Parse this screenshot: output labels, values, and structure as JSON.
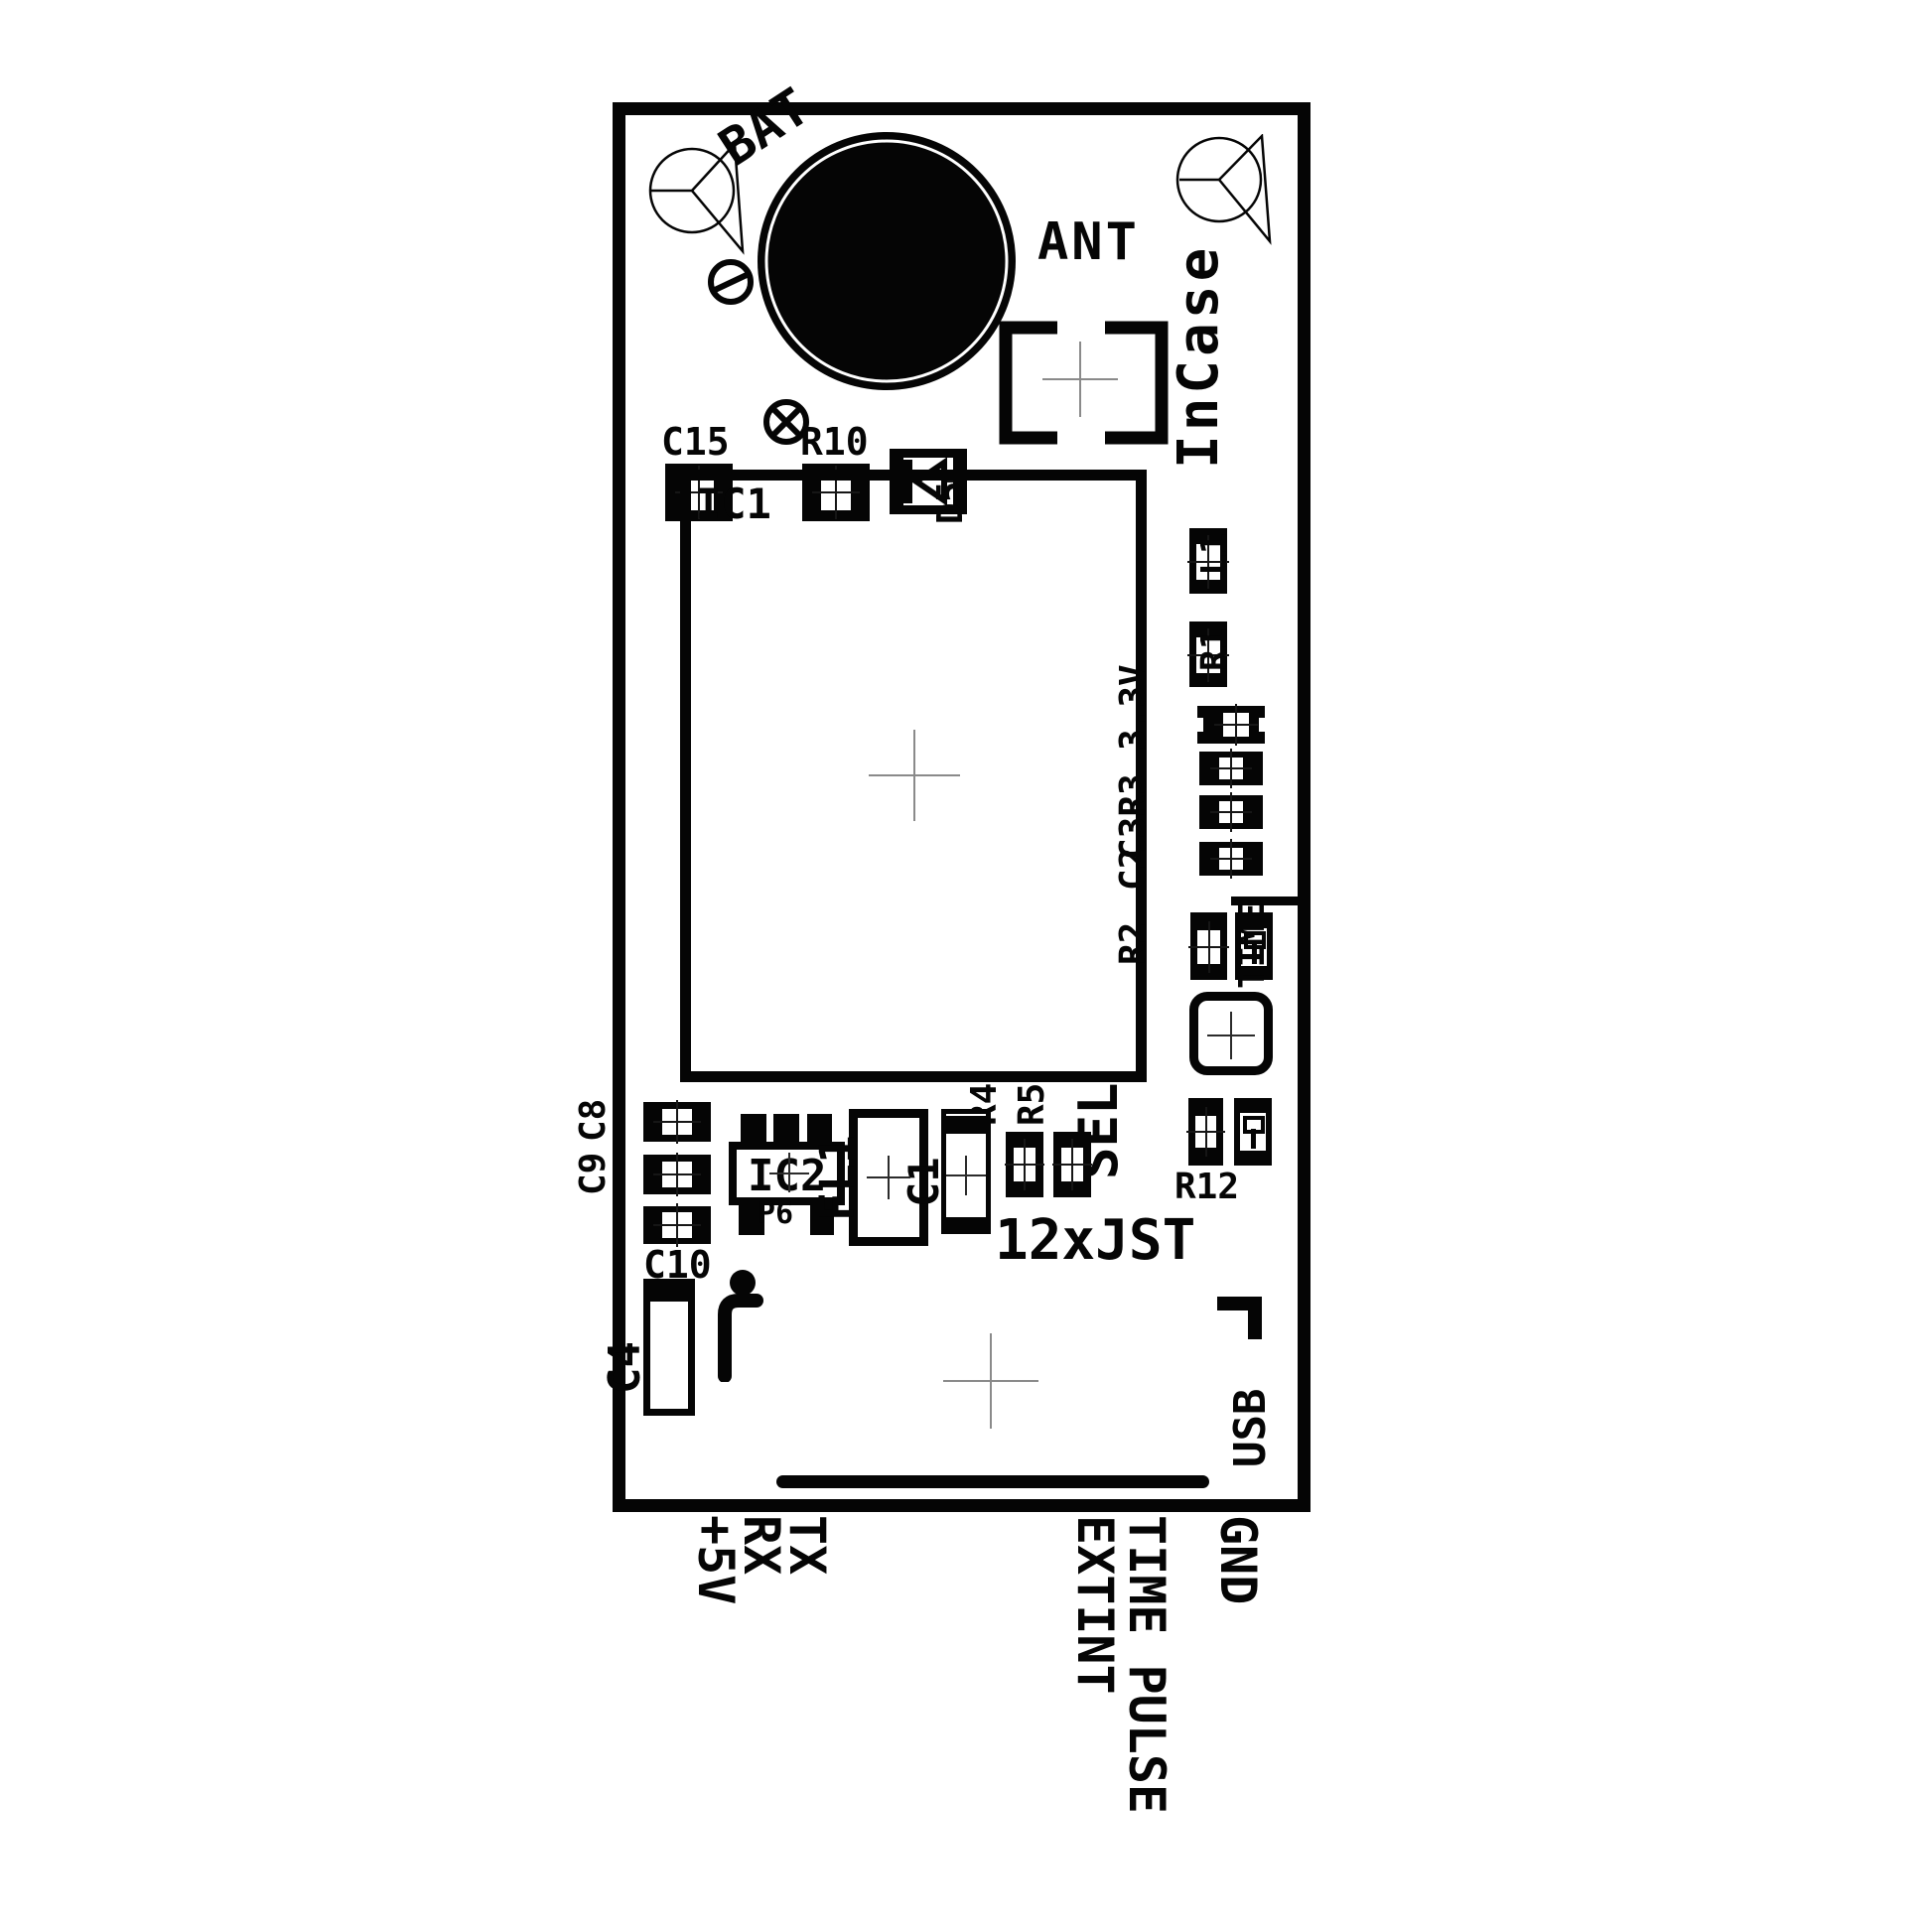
{
  "silkscreen": {
    "markings": {
      "brand": "InCase",
      "battery": "BAT",
      "antenna": "ANT",
      "connector": "12xJST",
      "button": "SEL",
      "usb": "USB",
      "time": "TIME",
      "voltage_3v3": "3.3V"
    },
    "components": {
      "c15": "C15",
      "r10": "R10",
      "d5": "D5",
      "ic1": "IC1",
      "l1": "L1",
      "r1": "R1",
      "c3r3": "C3R3",
      "c2": "C2",
      "r2": "R2",
      "r4": "R4",
      "r5": "R5",
      "r12": "R12",
      "ic2": "IC2",
      "p6": "P6",
      "fl1": "FL1",
      "c1": "C1",
      "c8": "C8",
      "c9": "C9",
      "c10": "C10",
      "c4": "C4"
    },
    "pins": {
      "tx": "TX",
      "rx": "RX",
      "plus5v": "+5V",
      "time_pulse": "TIME PULSE",
      "extint": "EXTINT",
      "gnd": "GND"
    }
  },
  "colors": {
    "silk": "#000000",
    "background": "#ffffff",
    "center_cross": "#8a8a8a"
  }
}
